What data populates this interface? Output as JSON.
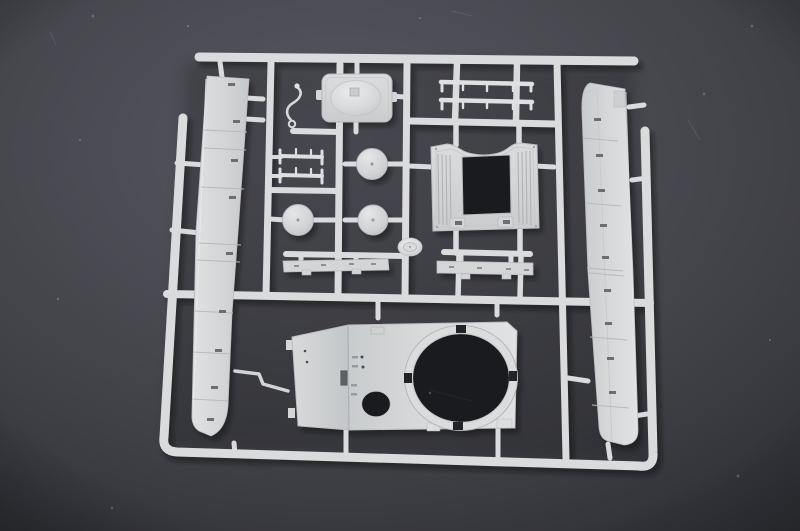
{
  "meta": {
    "domain": "Natural-Image",
    "subject": "injection-moulded model-kit sprue",
    "description": "Unpainted light-grey styrene sprue (runner frame) holding tank-model parts, photographed at a slight angle on a dark grey surface"
  },
  "palette": {
    "bg_center": "#55565c",
    "bg_mid": "#47484e",
    "bg_edge": "#393a40",
    "bg_corner": "#2f3035",
    "runner": "#d9dbdd",
    "plastic": "#d3d5d7",
    "plastic_light": "#e6e8e9",
    "plastic_mid": "#c7cacc",
    "plastic_dark": "#b3b6b8",
    "line": "#b9bcbe",
    "slot_dark": "#6c6f72",
    "hole": "#1a1b1e",
    "shadow": "#0c0c0f"
  },
  "sprue_contents": {
    "long_panel_strips": 2,
    "round_discs": 3,
    "thin_rails": 2,
    "flat_strips": 2,
    "axle_rods": 2,
    "domed_cover_plate": 1,
    "plate_with_square_opening": 1,
    "roof_plate_with_round_ring_opening": 1,
    "wire_hook_part": 1,
    "injection_point_boss": 1
  }
}
